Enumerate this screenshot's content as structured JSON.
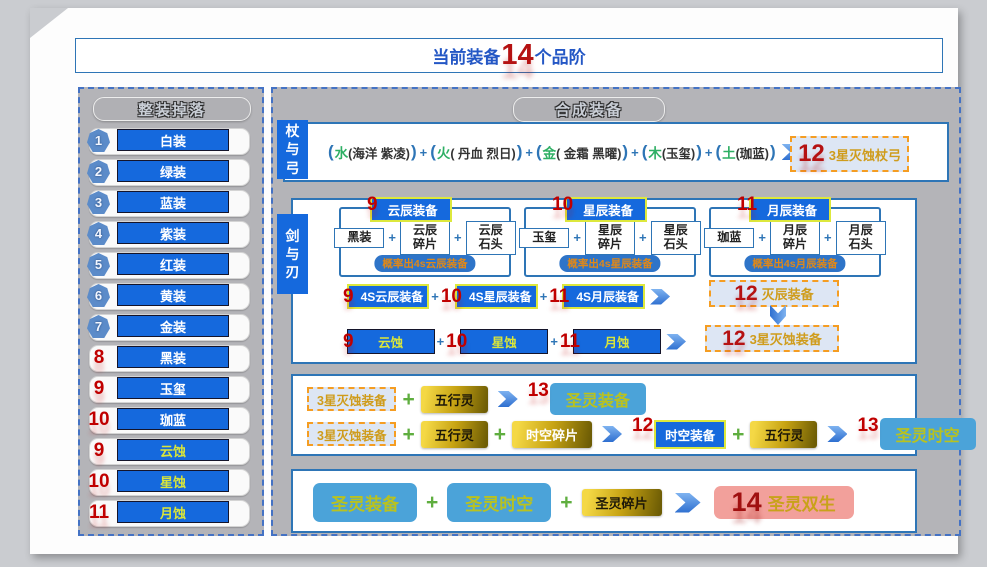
{
  "title": {
    "prefix": "当前装备",
    "count": "14",
    "suffix": "个品阶"
  },
  "sym": {
    "plus": "+",
    "lp": "(",
    "rp": ")"
  },
  "sidebar": {
    "header": "整装掉落",
    "items": [
      {
        "num": "1",
        "label": "白装"
      },
      {
        "num": "2",
        "label": "绿装"
      },
      {
        "num": "3",
        "label": "蓝装"
      },
      {
        "num": "4",
        "label": "紫装"
      },
      {
        "num": "5",
        "label": "红装"
      },
      {
        "num": "6",
        "label": "黄装"
      },
      {
        "num": "7",
        "label": "金装"
      },
      {
        "num": "8",
        "label": "黑装"
      },
      {
        "num": "9",
        "label": "玉玺"
      },
      {
        "num": "10",
        "label": "珈蓝"
      },
      {
        "num": "9",
        "label": "云蚀"
      },
      {
        "num": "10",
        "label": "星蚀"
      },
      {
        "num": "11",
        "label": "月蚀"
      }
    ]
  },
  "main": {
    "header": "合成装备",
    "staff_bow": {
      "label": "杖与弓",
      "groups": [
        {
          "element": "水",
          "detail": "(海洋 紫凌)"
        },
        {
          "element": "火",
          "detail": "( 丹血 烈日)"
        },
        {
          "element": "金",
          "detail": "( 金霜 黑曜)"
        },
        {
          "element": "木",
          "detail": "(玉玺)"
        },
        {
          "element": "土",
          "detail": "(珈蓝)"
        }
      ],
      "result": {
        "num": "12",
        "label": "3星灭蚀杖弓"
      }
    },
    "sword_blade": {
      "label": "剑与刃",
      "columns": [
        {
          "num": "9",
          "header": "云辰装备",
          "ing1": "黑装",
          "ing2": "云辰\n碎片",
          "ing3": "云辰\n石头",
          "note": "概率出4s云辰装备"
        },
        {
          "num": "10",
          "header": "星辰装备",
          "ing1": "玉玺",
          "ing2": "星辰\n碎片",
          "ing3": "星辰\n石头",
          "note": "概率出4s星辰装备"
        },
        {
          "num": "11",
          "header": "月辰装备",
          "ing1": "珈蓝",
          "ing2": "月辰\n碎片",
          "ing3": "月辰\n石头",
          "note": "概率出4s月辰装备"
        }
      ],
      "row_4s": {
        "item1": {
          "num": "9",
          "label": "4S云辰装备"
        },
        "item2": {
          "num": "10",
          "label": "4S星辰装备"
        },
        "item3": {
          "num": "11",
          "label": "4S月辰装备"
        },
        "result": {
          "num": "12",
          "label": "灭辰装备"
        }
      },
      "row_eclipse": {
        "item1": {
          "num": "9",
          "label": "云蚀"
        },
        "item2": {
          "num": "10",
          "label": "星蚀"
        },
        "item3": {
          "num": "11",
          "label": "月蚀"
        },
        "result": {
          "num": "12",
          "label": "3星灭蚀装备"
        }
      }
    },
    "holy": {
      "row1": {
        "input": "3星灭蚀装备",
        "mat1": "五行灵",
        "result": {
          "num": "13",
          "label": "圣灵装备"
        }
      },
      "row2": {
        "input": "3星灭蚀装备",
        "mat1": "五行灵",
        "mat2": "时空碎片",
        "mid": {
          "num": "12",
          "label": "时空装备"
        },
        "mat3": "五行灵",
        "result": {
          "num": "13",
          "label": "圣灵时空"
        }
      }
    },
    "twin": {
      "item1": "圣灵装备",
      "item2": "圣灵时空",
      "item3": "圣灵碎片",
      "result": {
        "num": "14",
        "label": "圣灵双生"
      }
    }
  }
}
